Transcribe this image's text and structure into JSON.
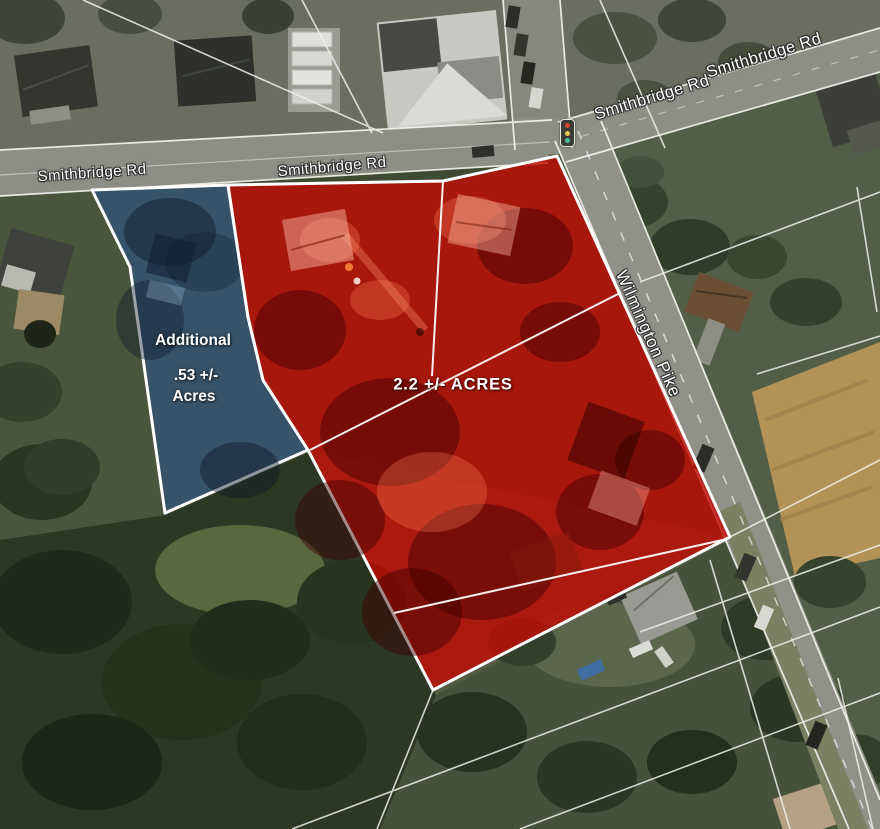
{
  "map": {
    "title": "Aerial parcel map",
    "road_labels": [
      {
        "id": "smithbridge-left",
        "text": "Smithbridge Rd"
      },
      {
        "id": "smithbridge-center",
        "text": "Smithbridge Rd"
      },
      {
        "id": "smithbridge-upper-right-west",
        "text": "Smithbridge Rd"
      },
      {
        "id": "smithbridge-upper-right-east",
        "text": "Smithbridge Rd"
      },
      {
        "id": "wilmington-pike",
        "text": "Wilmington Pike"
      }
    ],
    "parcels": {
      "primary": {
        "label": "2.2 +/- ACRES",
        "overlay_fill": "rgba(195,10,2,0.8)",
        "border_color": "#ffffff"
      },
      "additional": {
        "label_lines": [
          "Additional",
          ".53 +/-",
          "Acres"
        ],
        "overlay_fill": "rgba(53,87,126,0.72)",
        "border_color": "#ffffff"
      }
    },
    "icons": [
      {
        "id": "traffic-light",
        "lights": [
          "#d9442f",
          "#e4c84a",
          "#49b9a0"
        ]
      }
    ]
  }
}
